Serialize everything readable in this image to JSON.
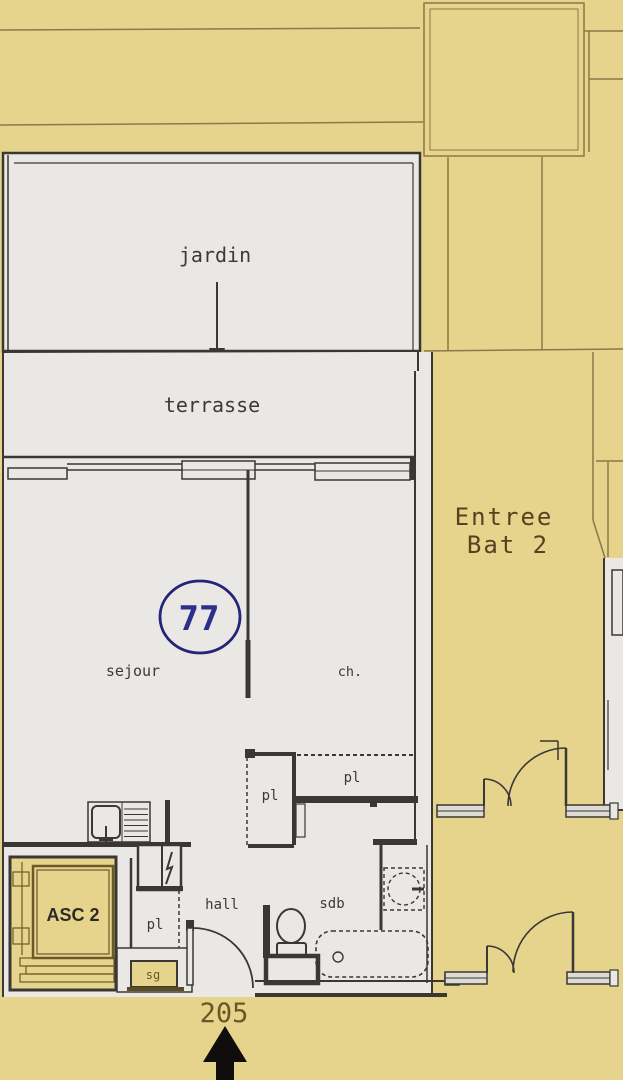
{
  "document_type": "architectural floor plan photo",
  "colors": {
    "paper_yellow": "#e6d48d",
    "plan_white": "#eae8e4",
    "wall_dark": "#3a3834",
    "background_line_olive": "#8a7a45",
    "elevator_line_olive": "#6a5a28",
    "label_dark": "#3c3a35",
    "label_olive": "#6b5726",
    "label_brown": "#53431f",
    "ink_blue": "#2d2f8c",
    "arrow_black": "#0f0e0c"
  },
  "rooms": {
    "garden": {
      "label": "jardin"
    },
    "terrace": {
      "label": "terrasse"
    },
    "living": {
      "label": "sejour"
    },
    "bedroom": {
      "label": "ch."
    },
    "closet_bedroom_left": {
      "label": "pl"
    },
    "closet_bedroom_right": {
      "label": "pl"
    },
    "closet_hall": {
      "label": "pl"
    },
    "hall": {
      "label": "hall"
    },
    "bathroom": {
      "label": "sdb"
    },
    "service_room": {
      "label": "sg"
    },
    "elevator": {
      "label": "ASC 2"
    }
  },
  "annotations": {
    "unit_number": "77",
    "entrance_label_line1": "Entree",
    "entrance_label_line2": "Bat 2",
    "door_number": "205"
  },
  "icons": {
    "garden_direction": "arrow-down-icon",
    "entrance_direction": "arrow-up-icon",
    "kitchen": "sink-icon",
    "electrical": "lightning-bolt-icon",
    "bathroom": [
      "toilet-icon",
      "bathtub-icon",
      "washing-machine-icon"
    ]
  }
}
